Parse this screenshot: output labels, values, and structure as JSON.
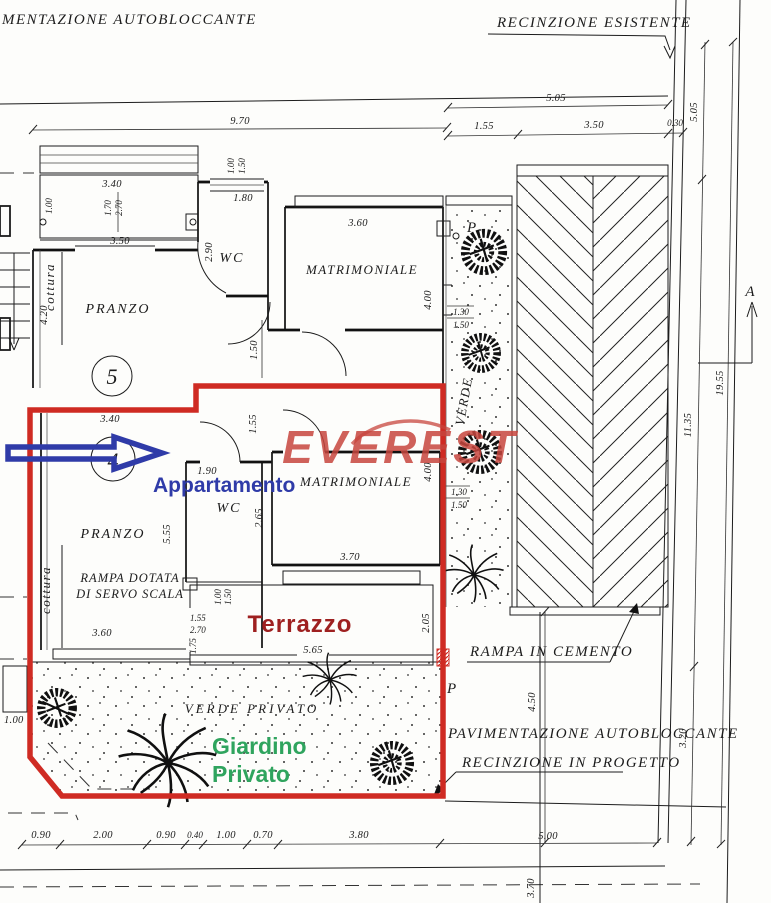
{
  "colors": {
    "red": "#cf2b23",
    "blue": "#2f3ba8",
    "green": "#2fa45e",
    "dark_red": "#9e2020",
    "watermark": "#c7463e"
  },
  "site": {
    "pav_top": "MENTAZIONE  AUTOBLOCCANTE",
    "rec_esistente": "RECINZIONE ESISTENTE",
    "rampa_cemento": "RAMPA IN CEMENTO",
    "pav_autobloccante": "PAVIMENTAZIONE AUTOBLOCCANTE",
    "rec_progetto": "RECINZIONE IN PROGETTO",
    "verde_privato": "VERDE PRIVATO",
    "verde": "VERDE",
    "section_a": "A"
  },
  "watermark": {
    "text": "EVEREST"
  },
  "overlay": {
    "appartamento": "Appartamento",
    "giardino_1": "Giardino",
    "giardino_2": "Privato",
    "terrazzo": "Terrazzo"
  },
  "unit5": {
    "number": "5",
    "pranzo": "PRANZO",
    "cottura": "cottura",
    "wc": "WC",
    "matrimoniale": "MATRIMONIALE",
    "p": "P"
  },
  "unit4": {
    "number": "4",
    "pranzo": "PRANZO",
    "cottura": "cottura",
    "wc": "WC",
    "matrimoniale": "MATRIMONIALE",
    "p": "P",
    "rampa_1": "RAMPA DOTATA",
    "rampa_2": "DI SERVO SCALA"
  },
  "dims": {
    "d970": "9.70",
    "d505h": "5.05",
    "d155t": "1.55",
    "d350t": "3.50",
    "d030": "0.30",
    "d505v": "5.05",
    "d1135": "11.35",
    "d1955": "19.55",
    "d320": "3.20",
    "d450": "4.50",
    "d500": "5.00",
    "d370b": "3.70",
    "u5_340": "3.40",
    "u5_100": "1.00",
    "u5_170": "1.70",
    "u5_270": "2.70",
    "u5_350": "3.50",
    "u5_420": "4.20",
    "u5_290": "2.90",
    "u5_180": "1.80",
    "u5_100b": "1.00",
    "u5_150b": "1.50",
    "u5_360": "3.60",
    "u5_400": "4.00",
    "u5_130": "1.30",
    "u5_150c": "1.50",
    "u5_150d": "1.50",
    "u4_340": "3.40",
    "u4_155": "1.55",
    "u4_190": "1.90",
    "u4_265": "2.65",
    "u4_555": "5.55",
    "u4_400": "4.00",
    "u4_130": "1.30",
    "u4_150": "1.50",
    "u4_370": "3.70",
    "u4_360": "3.60",
    "u4_100": "1.00",
    "u4_150b": "1.50",
    "u4_155b": "1.55",
    "u4_270": "2.70",
    "u4_175": "1.75",
    "u4_565": "5.65",
    "u4_205": "2.05",
    "u4_100L": "1.00",
    "b090a": "0.90",
    "b200": "2.00",
    "b090b": "0.90",
    "b040": "0.40",
    "b100": "1.00",
    "b070": "0.70",
    "b380": "3.80"
  }
}
